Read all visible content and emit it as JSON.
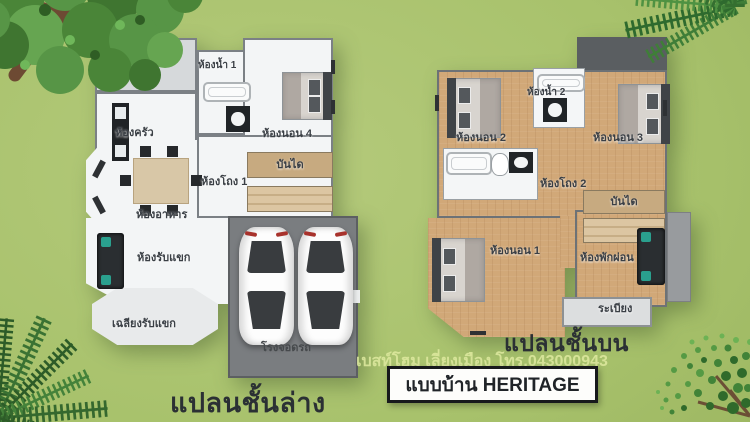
{
  "captions": {
    "ground_floor": "แปลนชั้นล่าง",
    "upper_floor": "แปลนชั้นบน",
    "watermark": "เบสท์โฮม เลี่ยงเมือง โทร.043000943",
    "house_model": "แบบบ้าน HERITAGE"
  },
  "ground_floor": {
    "rooms": {
      "laundry": "ซักล้าง",
      "bathroom1": "ห้องน้ำ 1",
      "kitchen": "ห้องครัว",
      "bedroom4": "ห้องนอน 4",
      "hall1": "ห้องโถง 1",
      "stairs": "บันได",
      "dining": "ห้องอาหาร",
      "living": "ห้องรับแขก",
      "porch": "เฉลียงรับแขก",
      "carport": "โรงจอดรถ"
    }
  },
  "upper_floor": {
    "rooms": {
      "bedroom2": "ห้องนอน 2",
      "bathroom2": "ห้องน้ำ 2",
      "bedroom3": "ห้องนอน 3",
      "hall2": "ห้องโถง 2",
      "stairs": "บันได",
      "bedroom1": "ห้องนอน 1",
      "lounge": "ห้องพักผ่อน",
      "balcony": "ระเบียง"
    }
  },
  "colors": {
    "grass": "#a8c26c",
    "wood_floor": "#d1a878",
    "white_floor": "#f3f5f6",
    "garage_floor": "#7a7d80",
    "roof_gray": "#5a5e61",
    "label_text": "#3a3f45",
    "watermark_text": "#dfeaa0",
    "caption_text": "#2b3034"
  }
}
